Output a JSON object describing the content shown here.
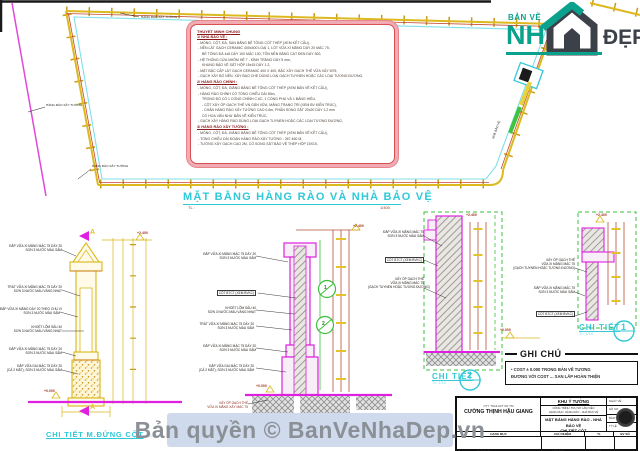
{
  "logo": {
    "top": "BẢN VẼ",
    "main": "NH",
    "suffix": "ĐẸP"
  },
  "watermark": {
    "text": "Bản quyền © BanVeNhaDep.vn"
  },
  "plan": {
    "title": "MẶT BẰNG HÀNG RÀO VÀ NHÀ BẢO VỆ",
    "scale_label": "TL :",
    "scale_value": "1/400",
    "label_top": "HÀNG RÀO XÂY TƯỜNG",
    "label_left": "HÀNG RÀO XÂY TƯỜNG",
    "label_bottom": "HÀNG RÀO XÂY TƯỜNG",
    "label_house": "NHÀ BẢO VỆ",
    "spec": {
      "title": "THUYẾT MINH CHUNG",
      "h1": "1/ NHÀ BẢO VỆ :",
      "s1": [
        "- MÓNG, CỘT, ĐÀ, SAN BẰNG BÊ TÔNG CỐT THÉP (XEM KẾT CẤU),",
        "- NỀN LÁT GẠCH CERAMIC 400x400 LOẠI 1, LÓT VỮA XI MĂNG DÀY 20 MÁC 75,",
        "BÊ TÔNG ĐÁ 4x6 DÀY 100 MÁC 100, TÔN NỀN BẰNG CÁT ĐEN DÀY 300,",
        "- HỆ THỐNG CỬA NHÔM HỆ 7 - KÍNH TRẮNG DÀY 5 mm,",
        "KHUNG BẢO VỆ SẮT HỘP 15x15 DÀY 1.2,",
        "- MẶT BẬC CẤP LÁT GẠCH CERAMIC 400 X 400, BẬC XÂY GẠCH THẺ VỮA XÂY M75,",
        "- GẠCH XÂY BÓ NỀN, XÂY BAO CHE DÙNG LOẠI GẠCH TUYNEN HOẶC CÁC LOẠI TƯƠNG ĐƯƠNG,"
      ],
      "h2": "2/ HÀNG RÀO CHÍNH :",
      "s2": [
        "- MÓNG, CỘT, ĐÀ, GIẰNG BẰNG BÊ TÔNG CỐT THÉP (XEM BẢN VẼ KẾT CẤU),",
        "- HÀNG RÀO CHÍNH CÓ TỔNG CHIỀU DÀI 80m,",
        "TRONG ĐÓ CÓ 1 CỔNG CHÍNH C.6C, 1 CỔNG PHỤ VÀ 1 BẢNG HIỆU,",
        "- CỘT XÂY ỐP GẠCH THẺ VN GẮN VỮA, MẢNG TRANG TRÍ (XEM BV KIẾN TRÚC),",
        "- CHÂN HÀNG RÀO XÂY TƯỜNG CAO 0.6m, PHẦN SONG SẮT 20x20 DÀY 1.2 mm",
        "CÓ HOA VĂN NHƯ BẢN VẼ KIẾN TRÚC,",
        "- GẠCH XÂY HÀNG RÀO DÙNG LOẠI GẠCH TUYNEN HOẶC CÁC LOẠI TƯƠNG ĐƯƠNG,"
      ],
      "h3": "3/ HÀNG RÀO XÂY TƯỜNG :",
      "s3": [
        "- MÓNG, CỘT, ĐÀ, GIẰNG BẰNG BÊ TÔNG CỐT THÉP (XEM BẢN VẼ KẾT CẤU),",
        "- TỔNG CHIỀU DÀI ĐOẠN HÀNG RÀO XÂY TƯỜNG : 267.460 M,",
        "- TƯỜNG XÂY GẠCH CAO 2M, CÓ SONG SẮT BẢO VỆ THÉP HỘP 15X15,"
      ]
    }
  },
  "d_left": {
    "title": "CHI TIẾT M.ĐỨNG CỘT",
    "scale": "TL: 1/20",
    "mark": "A",
    "elev_top": "+2.400",
    "elev_bottom": "+0.000",
    "ann": [
      [
        "ĐẮP VỮA XI MĂNG MÁC 75 DÀY 20",
        "SƠN 3 NƯỚC MÀU SẬM"
      ],
      [
        "TRÁT VỮA XI MĂNG MÁC 75 DÀY 20",
        "SƠN 3 NƯỚC MÀU VÀNG NHẠT"
      ],
      [
        "ĐẮP VỮA XI MĂNG DÀY 20 THEO CHU VI",
        "SƠN 3 NƯỚC MÀU SẬM"
      ],
      [
        "KHOÉT LÕM SÂU 40",
        "SƠN 3 NƯỚC MÀU VÀNG NHẠT"
      ],
      [
        "ĐẮP VỮA XI MĂNG MÁC 75 DÀY 20",
        "SƠN 3 NƯỚC MÀU SẬM"
      ],
      [
        "ĐẮP VỮA GAI MÁC 75 DÀY 20",
        "(CẢ 2 MẶT), SƠN 3 NƯỚC MÀU SẬM"
      ]
    ]
  },
  "d_mid": {
    "elev_top": "+2.400",
    "elev_bottom": "+0.000",
    "m1": "1",
    "m2": "2",
    "ann": [
      [
        "ĐẮP VỮA XI MĂNG MÁC 75 DÀY 20",
        "SƠN 3 NƯỚC MÀU SẬM"
      ],
      [
        "CỘT BTCT (XEM BVKC)",
        ""
      ],
      [
        "KHOÉT LÕM SÂU 40",
        "SƠN 3 NƯỚC MÀU VÀNG NHẠT"
      ],
      [
        "TRÁT VỮA XI MĂNG MÁC 75 DÀY 20",
        "SƠN 3 NƯỚC MÀU SẬM"
      ],
      [
        "ĐẮP VỮA XI MĂNG MÁC 75 DÀY 20",
        "SƠN 3 NƯỚC MÀU SẬM"
      ],
      [
        "ĐẮP VỮA GAI MÁC 75 DÀY 20",
        "(CẢ 2 MẶT), SƠN 3 NƯỚC MÀU SẬM"
      ]
    ],
    "gnote": [
      "XÂY ỐP GẠCH THẺ",
      "VỮA XI MĂNG XÂY MÁC 75"
    ]
  },
  "d2": {
    "label": "CHI TIẾT",
    "num": "2",
    "scale": "TL: 1/10",
    "elev_top": "+2.400",
    "ann": [
      [
        "ĐẮP VỮA XI MĂNG MÁC 75",
        "SƠN 3 NƯỚC MÀU SẬM",
        ""
      ],
      [
        "CỘT BTCT (XEM BVKC)",
        "",
        ""
      ],
      [
        "XÂY ỐP GẠCH THẺ",
        "VỮA XI MĂNG MÁC 75",
        "(GẠCH TUYNEN HOẶC TƯƠNG ĐƯƠNG)"
      ]
    ]
  },
  "d1": {
    "label": "CHI TIẾT",
    "num": "1",
    "scale": "TL: 1/10",
    "elev_top": "+2.400",
    "elev_bottom": "+0.000",
    "ann": [
      [
        "XÂY ỐP GẠCH THẺ",
        "VỮA XI MĂNG MÁC 75",
        "(GẠCH TUYNEN HOẶC TƯƠNG ĐƯƠNG)"
      ],
      [
        "ĐẮP VỮA XI MĂNG MÁC 75",
        "SƠN 3 NƯỚC MÀU SẬM",
        ""
      ],
      [
        "CỘT BTCT (XEM BVKC)",
        "",
        ""
      ]
    ]
  },
  "notes": {
    "title": "GHI CHÚ",
    "l1": "• COST ± 0.000 TRONG BẢN VẼ TƯƠNG",
    "l2": "ĐƯƠNG VỚI COST ... SAN LẤP HOÀN THIỆN"
  },
  "tb": {
    "company_type": "CTY TNHH ĐT XD TM",
    "company_name": "CƯỜNG THỊNH HẬU GIANG",
    "project": "KHU Ý TƯỞNG",
    "desc1": "CÔNG TRÌNH: TRỤ SỞ LÀM VIỆC",
    "desc2": "HẠNG MỤC: HÀNG RÀO - NHÀ BẢO VỆ",
    "title1": "MẶT BẰNG HÀNG RÀO - NHÀ BẢO VỆ",
    "title2": "CHI TIẾT CỘT",
    "r1": "NGÀY VẼ",
    "r2": "HỒ SƠ",
    "r3": "BẢN VẼ",
    "r4": "TỶ LỆ",
    "h1": "HẠNG MỤC",
    "h2": "CHỦ NHIỆM",
    "h3": "TL",
    "h4": "BV SỐ",
    "b1": "NGƯỜI VẼ",
    "b2": "KIỂM TRA",
    "b3": "CHỦ TRÌ"
  }
}
